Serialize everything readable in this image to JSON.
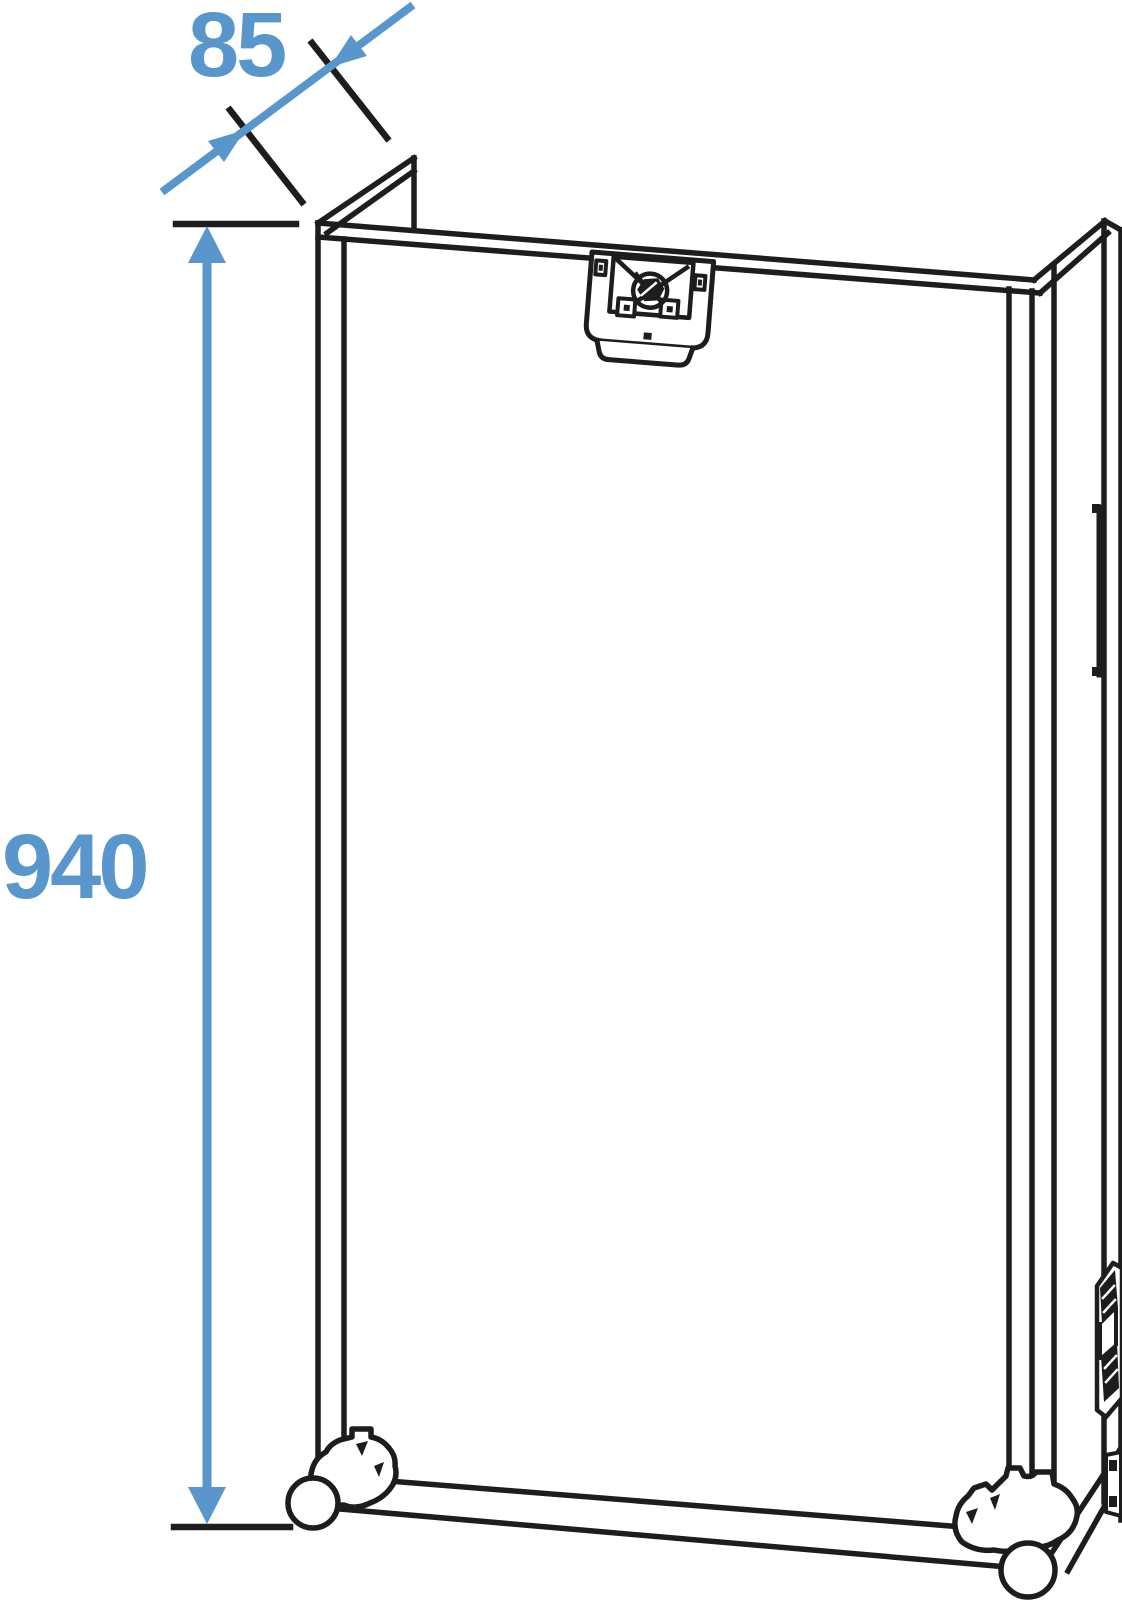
{
  "meta": {
    "subject": "Technical line drawing of an open flight rack case with dimension annotations",
    "background": "#ffffff"
  },
  "colors": {
    "line_black": "#1d1d1d",
    "dimension_blue": "#5896CB",
    "fill_white": "#ffffff"
  },
  "dimensions": {
    "height": {
      "label": "940",
      "orientation": "vertical"
    },
    "depth": {
      "label": "85",
      "orientation": "diagonal"
    }
  },
  "parts": {
    "latch": "butterfly-latch",
    "left_caster": "caster-wheel",
    "right_caster": "caster-wheel",
    "upper_hinge": "hinge",
    "lower_hinge": "hinge",
    "corner_bracket": "corner-bracket"
  }
}
